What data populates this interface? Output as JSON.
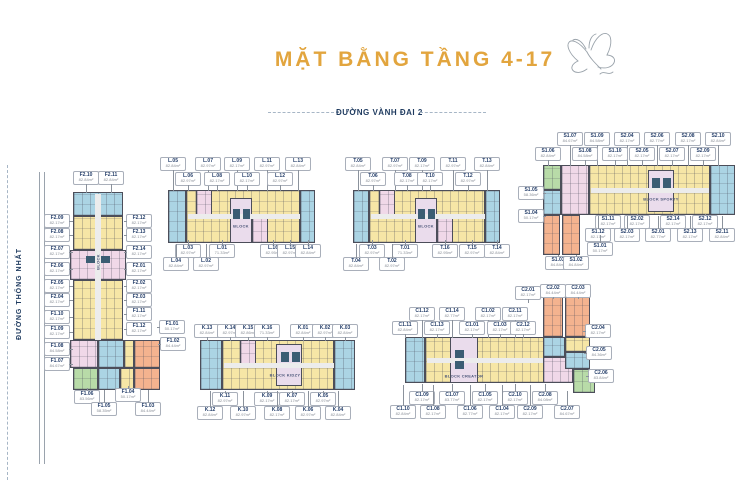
{
  "title": "MẶT BẰNG TẦNG 4-17",
  "roads": {
    "top": "ĐƯỜNG VÀNH ĐAI 2",
    "left": "ĐƯỜNG THỐNG NHẤT"
  },
  "colors": {
    "accent_gold": "#E2A53E",
    "navy": "#1E3A5F",
    "unit_yellow": "#F6E6A6",
    "unit_blue": "#ABD4E4",
    "unit_pink": "#F0D8E8",
    "unit_orange": "#F4B38F",
    "unit_green": "#B8DBA8",
    "outline": "#4C4E5A"
  },
  "blocks": {
    "f": {
      "name": "BLOCK",
      "labels": [
        {
          "c": "F2.10",
          "a": "82.84m²",
          "x": 86,
          "y": 177,
          "d": "d",
          "n": 9
        },
        {
          "c": "F2.11",
          "a": "82.84m²",
          "x": 111,
          "y": 177,
          "d": "d",
          "n": 9
        },
        {
          "c": "F2.09",
          "a": "82.17m²",
          "x": 57,
          "y": 220,
          "d": "r",
          "n": 4
        },
        {
          "c": "F2.08",
          "a": "82.17m²",
          "x": 57,
          "y": 234,
          "d": "r",
          "n": 4
        },
        {
          "c": "F2.07",
          "a": "82.17m²",
          "x": 57,
          "y": 251,
          "d": "r",
          "n": 4
        },
        {
          "c": "F2.06",
          "a": "82.17m²",
          "x": 57,
          "y": 268,
          "d": "r",
          "n": 4
        },
        {
          "c": "F2.05",
          "a": "82.17m²",
          "x": 57,
          "y": 285,
          "d": "r",
          "n": 4
        },
        {
          "c": "F2.04",
          "a": "82.17m²",
          "x": 57,
          "y": 299,
          "d": "r",
          "n": 4
        },
        {
          "c": "F1.10",
          "a": "82.17m²",
          "x": 57,
          "y": 316,
          "d": "r",
          "n": 4
        },
        {
          "c": "F1.09",
          "a": "82.17m²",
          "x": 57,
          "y": 331,
          "d": "r",
          "n": 4
        },
        {
          "c": "F1.08",
          "a": "84.58m²",
          "x": 57,
          "y": 348,
          "d": "r",
          "n": 4
        },
        {
          "c": "F1.07",
          "a": "84.67m²",
          "x": 57,
          "y": 363,
          "d": "r",
          "n": 4
        },
        {
          "c": "F2.12",
          "a": "82.17m²",
          "x": 139,
          "y": 220,
          "d": "l",
          "n": 3
        },
        {
          "c": "F2.13",
          "a": "82.17m²",
          "x": 139,
          "y": 234,
          "d": "l",
          "n": 3
        },
        {
          "c": "F2.14",
          "a": "82.17m²",
          "x": 139,
          "y": 251,
          "d": "l",
          "n": 3
        },
        {
          "c": "F2.01",
          "a": "82.17m²",
          "x": 139,
          "y": 268,
          "d": "l",
          "n": 3
        },
        {
          "c": "F2.02",
          "a": "82.17m²",
          "x": 139,
          "y": 285,
          "d": "l",
          "n": 3
        },
        {
          "c": "F2.03",
          "a": "82.17m²",
          "x": 139,
          "y": 299,
          "d": "l",
          "n": 3
        },
        {
          "c": "F1.11",
          "a": "82.17m²",
          "x": 139,
          "y": 313,
          "d": "l",
          "n": 3
        },
        {
          "c": "F1.12",
          "a": "82.17m²",
          "x": 139,
          "y": 328,
          "d": "l",
          "n": 3
        },
        {
          "c": "F1.01",
          "a": "50.17m²",
          "x": 172,
          "y": 326,
          "d": "l",
          "n": 3
        },
        {
          "c": "F1.02",
          "a": "84.44m²",
          "x": 173,
          "y": 343,
          "d": "l",
          "n": 3
        },
        {
          "c": "F1.06",
          "a": "83.56m²",
          "x": 87,
          "y": 396,
          "d": "u",
          "n": 3
        },
        {
          "c": "F1.04",
          "a": "50.17m²",
          "x": 128,
          "y": 394,
          "d": "u",
          "n": 3
        },
        {
          "c": "F1.05",
          "a": "58.35m²",
          "x": 104,
          "y": 408,
          "d": "u",
          "n": 13
        },
        {
          "c": "F1.03",
          "a": "84.44m²",
          "x": 148,
          "y": 408,
          "d": "u",
          "n": 13
        }
      ]
    },
    "l": {
      "name": "BLOCK",
      "labels": [
        {
          "c": "L.05",
          "a": "82.84m²",
          "x": 173,
          "y": 163,
          "d": "d",
          "n": 21
        },
        {
          "c": "L.07",
          "a": "82.97m²",
          "x": 208,
          "y": 163,
          "d": "d",
          "n": 21
        },
        {
          "c": "L.09",
          "a": "82.17m²",
          "x": 237,
          "y": 163,
          "d": "d",
          "n": 21
        },
        {
          "c": "L.11",
          "a": "82.97m²",
          "x": 267,
          "y": 163,
          "d": "d",
          "n": 21
        },
        {
          "c": "L.13",
          "a": "82.84m²",
          "x": 298,
          "y": 163,
          "d": "d",
          "n": 21
        },
        {
          "c": "L.06",
          "a": "82.97m²",
          "x": 188,
          "y": 178,
          "d": "d",
          "n": 6
        },
        {
          "c": "L.08",
          "a": "82.17m²",
          "x": 217,
          "y": 178,
          "d": "d",
          "n": 6
        },
        {
          "c": "L.10",
          "a": "82.17m²",
          "x": 247,
          "y": 178,
          "d": "d",
          "n": 6
        },
        {
          "c": "L.12",
          "a": "82.97m²",
          "x": 280,
          "y": 178,
          "d": "d",
          "n": 6
        },
        {
          "c": "L.03",
          "a": "82.97m²",
          "x": 188,
          "y": 250,
          "d": "u",
          "n": 5
        },
        {
          "c": "L.01",
          "a": "71.33m²",
          "x": 222,
          "y": 250,
          "d": "u",
          "n": 5
        },
        {
          "c": "L.16",
          "a": "82.95m²",
          "x": 273,
          "y": 250,
          "d": "u",
          "n": 5
        },
        {
          "c": "L.15",
          "a": "82.97m²",
          "x": 290,
          "y": 250,
          "d": "u",
          "n": 5
        },
        {
          "c": "L.14",
          "a": "82.84m²",
          "x": 308,
          "y": 250,
          "d": "u",
          "n": 5
        },
        {
          "c": "L.04",
          "a": "82.84m²",
          "x": 176,
          "y": 263,
          "d": "u",
          "n": 14
        },
        {
          "c": "L.02",
          "a": "82.97m²",
          "x": 206,
          "y": 263,
          "d": "u",
          "n": 14
        }
      ]
    },
    "t": {
      "name": "BLOCK",
      "labels": [
        {
          "c": "T.05",
          "a": "82.84m²",
          "x": 358,
          "y": 163,
          "d": "d",
          "n": 21
        },
        {
          "c": "T.07",
          "a": "82.97m²",
          "x": 395,
          "y": 163,
          "d": "d",
          "n": 21
        },
        {
          "c": "T.09",
          "a": "82.17m²",
          "x": 422,
          "y": 163,
          "d": "d",
          "n": 21
        },
        {
          "c": "T.11",
          "a": "82.97m²",
          "x": 453,
          "y": 163,
          "d": "d",
          "n": 21
        },
        {
          "c": "T.13",
          "a": "82.84m²",
          "x": 487,
          "y": 163,
          "d": "d",
          "n": 21
        },
        {
          "c": "T.06",
          "a": "82.97m²",
          "x": 373,
          "y": 178,
          "d": "d",
          "n": 6
        },
        {
          "c": "T.08",
          "a": "82.17m²",
          "x": 407,
          "y": 178,
          "d": "d",
          "n": 6
        },
        {
          "c": "T.10",
          "a": "82.17m²",
          "x": 430,
          "y": 178,
          "d": "d",
          "n": 6
        },
        {
          "c": "T.12",
          "a": "82.97m²",
          "x": 468,
          "y": 178,
          "d": "d",
          "n": 6
        },
        {
          "c": "T.03",
          "a": "82.97m²",
          "x": 372,
          "y": 250,
          "d": "u",
          "n": 5
        },
        {
          "c": "T.01",
          "a": "71.33m²",
          "x": 405,
          "y": 250,
          "d": "u",
          "n": 5
        },
        {
          "c": "T.16",
          "a": "82.95m²",
          "x": 445,
          "y": 250,
          "d": "u",
          "n": 5
        },
        {
          "c": "T.15",
          "a": "82.97m²",
          "x": 472,
          "y": 250,
          "d": "u",
          "n": 5
        },
        {
          "c": "T.14",
          "a": "82.84m²",
          "x": 497,
          "y": 250,
          "d": "u",
          "n": 5
        },
        {
          "c": "T.04",
          "a": "82.84m²",
          "x": 356,
          "y": 263,
          "d": "u",
          "n": 14
        },
        {
          "c": "T.02",
          "a": "82.97m²",
          "x": 392,
          "y": 263,
          "d": "u",
          "n": 14
        }
      ]
    },
    "s": {
      "name": "BLOCK SPORTY",
      "labels": [
        {
          "c": "S1.07",
          "a": "84.67m²",
          "x": 570,
          "y": 138,
          "d": "d",
          "n": 21
        },
        {
          "c": "S1.09",
          "a": "84.58m²",
          "x": 597,
          "y": 138,
          "d": "d",
          "n": 21
        },
        {
          "c": "S2.04",
          "a": "82.17m²",
          "x": 627,
          "y": 138,
          "d": "d",
          "n": 21
        },
        {
          "c": "S2.06",
          "a": "82.77m²",
          "x": 657,
          "y": 138,
          "d": "d",
          "n": 21
        },
        {
          "c": "S2.08",
          "a": "82.17m²",
          "x": 688,
          "y": 138,
          "d": "d",
          "n": 21
        },
        {
          "c": "S2.10",
          "a": "82.84m²",
          "x": 718,
          "y": 138,
          "d": "d",
          "n": 21
        },
        {
          "c": "S1.06",
          "a": "82.84m²",
          "x": 548,
          "y": 153,
          "d": "d",
          "n": 6
        },
        {
          "c": "S1.08",
          "a": "84.58m²",
          "x": 585,
          "y": 153,
          "d": "d",
          "n": 6
        },
        {
          "c": "S1.10",
          "a": "82.17m²",
          "x": 615,
          "y": 153,
          "d": "d",
          "n": 6
        },
        {
          "c": "S2.05",
          "a": "82.17m²",
          "x": 642,
          "y": 153,
          "d": "d",
          "n": 6
        },
        {
          "c": "S2.07",
          "a": "82.17m²",
          "x": 672,
          "y": 153,
          "d": "d",
          "n": 6
        },
        {
          "c": "S2.09",
          "a": "82.17m²",
          "x": 703,
          "y": 153,
          "d": "d",
          "n": 6
        },
        {
          "c": "S1.05",
          "a": "58.36m²",
          "x": 531,
          "y": 192,
          "d": "r",
          "n": 3
        },
        {
          "c": "S1.04",
          "a": "50.17m²",
          "x": 531,
          "y": 215,
          "d": "r",
          "n": 3
        },
        {
          "c": "S1.11",
          "a": "82.17m²",
          "x": 608,
          "y": 221,
          "d": "u",
          "n": 2
        },
        {
          "c": "S2.02",
          "a": "82.17m²",
          "x": 637,
          "y": 221,
          "d": "u",
          "n": 2
        },
        {
          "c": "S2.14",
          "a": "82.17m²",
          "x": 673,
          "y": 221,
          "d": "u",
          "n": 2
        },
        {
          "c": "S2.12",
          "a": "82.17m²",
          "x": 705,
          "y": 221,
          "d": "u",
          "n": 2
        },
        {
          "c": "S1.12",
          "a": "82.17m²",
          "x": 598,
          "y": 234,
          "d": "u",
          "n": 13
        },
        {
          "c": "S2.03",
          "a": "82.17m²",
          "x": 627,
          "y": 234,
          "d": "u",
          "n": 13
        },
        {
          "c": "S2.01",
          "a": "82.77m²",
          "x": 658,
          "y": 234,
          "d": "u",
          "n": 13
        },
        {
          "c": "S2.13",
          "a": "82.17m²",
          "x": 690,
          "y": 234,
          "d": "u",
          "n": 13
        },
        {
          "c": "S2.11",
          "a": "82.84m²",
          "x": 722,
          "y": 234,
          "d": "u",
          "n": 13
        },
        {
          "c": "S1.01",
          "a": "50.17m²",
          "x": 600,
          "y": 248,
          "d": "u",
          "n": 8
        },
        {
          "c": "S1.03",
          "a": "84.84m²",
          "x": 558,
          "y": 262,
          "d": "u",
          "n": 2
        },
        {
          "c": "S1.02",
          "a": "84.84m²",
          "x": 576,
          "y": 262,
          "d": "u",
          "n": 2
        }
      ]
    },
    "k": {
      "name": "BLOCK KIDZY",
      "labels": [
        {
          "c": "K.13",
          "a": "82.84m²",
          "x": 207,
          "y": 330,
          "d": "d",
          "n": 4
        },
        {
          "c": "K.14",
          "a": "82.97m²",
          "x": 230,
          "y": 330,
          "d": "d",
          "n": 4
        },
        {
          "c": "K.15",
          "a": "82.86m²",
          "x": 248,
          "y": 330,
          "d": "d",
          "n": 4
        },
        {
          "c": "K.16",
          "a": "71.33m²",
          "x": 267,
          "y": 330,
          "d": "d",
          "n": 4
        },
        {
          "c": "K.01",
          "a": "82.84m²",
          "x": 303,
          "y": 330,
          "d": "d",
          "n": 4
        },
        {
          "c": "K.02",
          "a": "82.97m²",
          "x": 325,
          "y": 330,
          "d": "d",
          "n": 4
        },
        {
          "c": "K.03",
          "a": "82.84m²",
          "x": 345,
          "y": 330,
          "d": "d",
          "n": 4
        },
        {
          "c": "K.11",
          "a": "82.97m²",
          "x": 225,
          "y": 398,
          "d": "u",
          "n": 2
        },
        {
          "c": "K.09",
          "a": "82.17m²",
          "x": 267,
          "y": 398,
          "d": "u",
          "n": 2
        },
        {
          "c": "K.07",
          "a": "82.17m²",
          "x": 292,
          "y": 398,
          "d": "u",
          "n": 2
        },
        {
          "c": "K.05",
          "a": "82.97m²",
          "x": 323,
          "y": 398,
          "d": "u",
          "n": 2
        },
        {
          "c": "K.12",
          "a": "82.84m²",
          "x": 210,
          "y": 412,
          "d": "u",
          "n": 16
        },
        {
          "c": "K.10",
          "a": "82.97m²",
          "x": 243,
          "y": 412,
          "d": "u",
          "n": 16
        },
        {
          "c": "K.08",
          "a": "82.17m²",
          "x": 277,
          "y": 412,
          "d": "u",
          "n": 16
        },
        {
          "c": "K.06",
          "a": "82.97m²",
          "x": 308,
          "y": 412,
          "d": "u",
          "n": 16
        },
        {
          "c": "K.04",
          "a": "82.84m²",
          "x": 338,
          "y": 412,
          "d": "u",
          "n": 16
        }
      ]
    },
    "c": {
      "name": "BLOCK CREATOR",
      "labels": [
        {
          "c": "C2.01",
          "a": "82.17m²",
          "x": 528,
          "y": 292,
          "d": "d",
          "n": 4
        },
        {
          "c": "C2.02",
          "a": "84.44m²",
          "x": 553,
          "y": 290,
          "d": "d",
          "n": 2
        },
        {
          "c": "C2.03",
          "a": "84.44m²",
          "x": 578,
          "y": 290,
          "d": "d",
          "n": 2
        },
        {
          "c": "C1.12",
          "a": "82.17m²",
          "x": 422,
          "y": 313,
          "d": "d",
          "n": 18
        },
        {
          "c": "C1.14",
          "a": "82.77m²",
          "x": 452,
          "y": 313,
          "d": "d",
          "n": 18
        },
        {
          "c": "C1.02",
          "a": "82.17m²",
          "x": 488,
          "y": 313,
          "d": "d",
          "n": 18
        },
        {
          "c": "C2.11",
          "a": "82.17m²",
          "x": 515,
          "y": 313,
          "d": "d",
          "n": 18
        },
        {
          "c": "C1.11",
          "a": "82.84m²",
          "x": 405,
          "y": 327,
          "d": "d",
          "n": 4
        },
        {
          "c": "C1.13",
          "a": "82.17m²",
          "x": 437,
          "y": 327,
          "d": "d",
          "n": 4
        },
        {
          "c": "C1.01",
          "a": "82.17m²",
          "x": 472,
          "y": 327,
          "d": "d",
          "n": 4
        },
        {
          "c": "C1.03",
          "a": "82.17m²",
          "x": 500,
          "y": 327,
          "d": "d",
          "n": 4
        },
        {
          "c": "C2.12",
          "a": "82.17m²",
          "x": 523,
          "y": 327,
          "d": "d",
          "n": 4
        },
        {
          "c": "C2.04",
          "a": "82.17m²",
          "x": 598,
          "y": 330,
          "d": "l",
          "n": 3
        },
        {
          "c": "C2.05",
          "a": "84.36m²",
          "x": 599,
          "y": 352,
          "d": "l",
          "n": 3
        },
        {
          "c": "C2.06",
          "a": "83.84m²",
          "x": 601,
          "y": 375,
          "d": "l",
          "n": 3
        },
        {
          "c": "C1.09",
          "a": "82.17m²",
          "x": 422,
          "y": 397,
          "d": "u",
          "n": 8
        },
        {
          "c": "C1.07",
          "a": "83.77m²",
          "x": 452,
          "y": 397,
          "d": "u",
          "n": 8
        },
        {
          "c": "C1.05",
          "a": "82.17m²",
          "x": 485,
          "y": 397,
          "d": "u",
          "n": 8
        },
        {
          "c": "C2.10",
          "a": "82.17m²",
          "x": 515,
          "y": 397,
          "d": "u",
          "n": 8
        },
        {
          "c": "C2.08",
          "a": "84.08m²",
          "x": 545,
          "y": 397,
          "d": "u",
          "n": 8
        },
        {
          "c": "C1.10",
          "a": "82.84m²",
          "x": 403,
          "y": 411,
          "d": "u",
          "n": 21
        },
        {
          "c": "C1.08",
          "a": "82.17m²",
          "x": 433,
          "y": 411,
          "d": "u",
          "n": 21
        },
        {
          "c": "C1.06",
          "a": "82.77m²",
          "x": 470,
          "y": 411,
          "d": "u",
          "n": 21
        },
        {
          "c": "C1.04",
          "a": "82.17m²",
          "x": 502,
          "y": 411,
          "d": "u",
          "n": 21
        },
        {
          "c": "C2.09",
          "a": "82.17m²",
          "x": 530,
          "y": 411,
          "d": "u",
          "n": 21
        },
        {
          "c": "C2.07",
          "a": "84.67m²",
          "x": 567,
          "y": 411,
          "d": "u",
          "n": 15
        }
      ]
    }
  }
}
